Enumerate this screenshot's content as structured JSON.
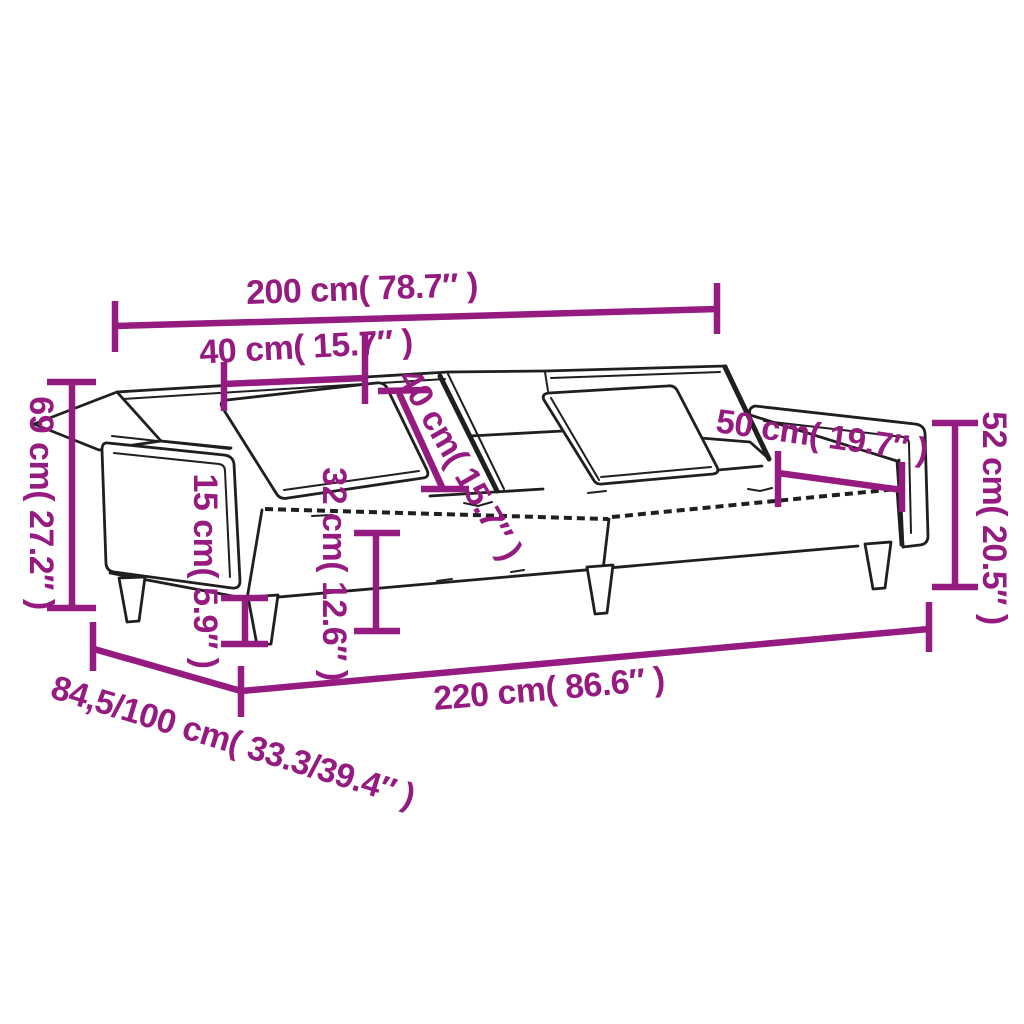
{
  "figure": {
    "kind": "product dimension diagram",
    "product": "2-seater sofa bed with pillows",
    "accent_color": "#951b81",
    "line_color": "#1f1f1f",
    "background_color": "#ffffff"
  },
  "dimensions": {
    "width_200": {
      "label": "200 cm( 78.7″ )"
    },
    "pillow_w_40": {
      "label": "40 cm( 15.7″ )"
    },
    "pillow_h_40": {
      "label": "40 cm( 15.7″ )"
    },
    "height_69": {
      "label": "69 cm( 27.2″ )"
    },
    "leg_15": {
      "label": "15 cm( 5.9″ )"
    },
    "seat_32": {
      "label": "32 cm( 12.6″ )"
    },
    "back_52": {
      "label": "52 cm( 20.5″ )"
    },
    "arm_50": {
      "label": "50 cm( 19.7″ )"
    },
    "length_220": {
      "label": "220 cm( 86.6″ )"
    },
    "depth_84": {
      "label": "84,5/100 cm( 33.3/39.4″ )"
    }
  }
}
